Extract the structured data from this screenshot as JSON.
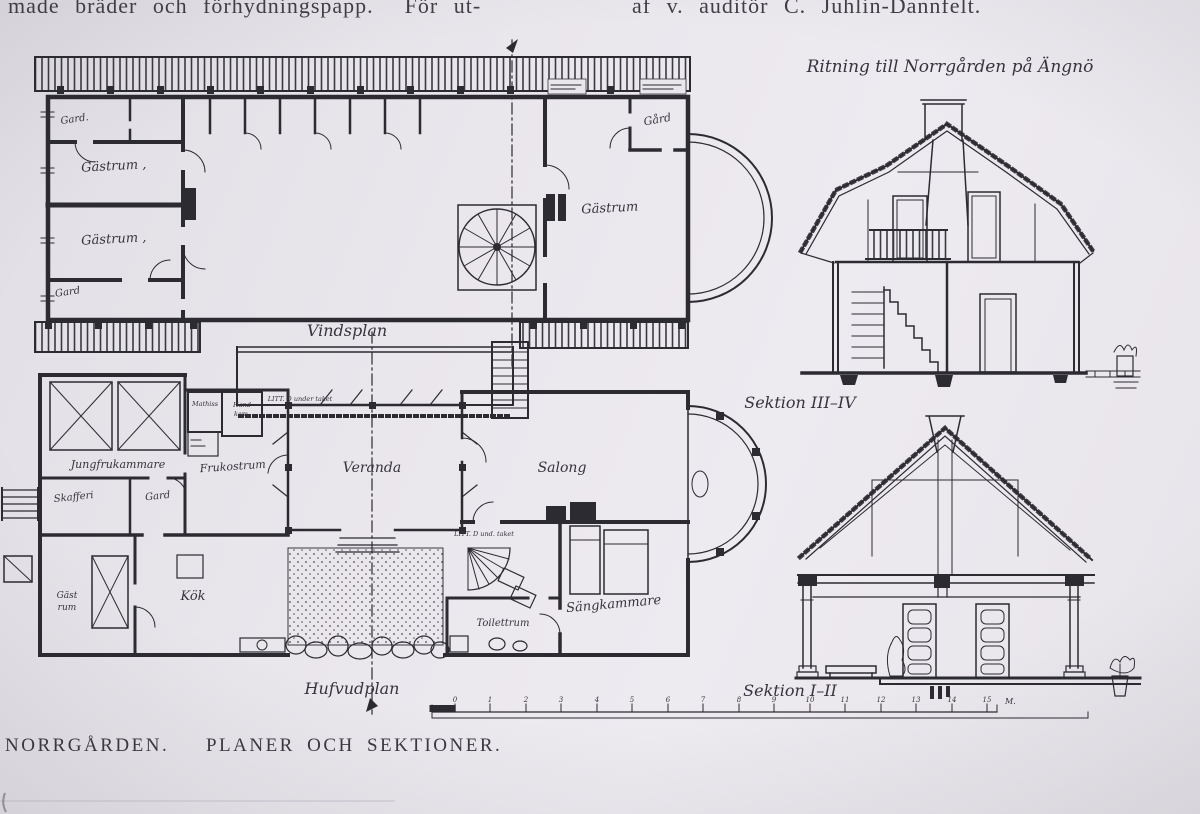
{
  "page": {
    "top_text_left": "made bräder och förhydningspapp.  För ut-",
    "top_text_right": "af v. auditör C. Juhlin-Dannfelt.",
    "caption": "NORRGÅRDEN.   PLANER OCH SEKTIONER.",
    "paper_color": "#e9e6ec",
    "ink_color": "#2c2b32"
  },
  "drawing": {
    "title": "Ritning till Norrgården på Ängnö",
    "attic_plan": {
      "label": "Vindsplan",
      "rooms": {
        "gard_top_left": "Gard.",
        "gastrum_1": "Gästrum ,",
        "gastrum_2": "Gästrum ,",
        "gard_bottom_left": "Gard",
        "gard_top_right": "Gård",
        "gastrum_3": "Gästrum"
      }
    },
    "main_plan": {
      "label": "Hufvudplan",
      "rooms": {
        "jungfrukammare": "Jungfrukammare",
        "skafferi": "Skafferi",
        "gard": "Gard",
        "mathiss": "Mathiss",
        "handkammare_line1": "Hand",
        "handkammare_line2": "kam.",
        "litt_d_note_1": "LITT. D under taket",
        "frukostrum": "Frukostrum",
        "veranda": "Veranda",
        "salong": "Salong",
        "gastrum_line1": "Gäst",
        "gastrum_line2": "rum",
        "kok": "Kök",
        "litt_d_note_2": "LITT. D und. taket",
        "toilettrum": "Toilettrum",
        "sangkammare": "Sängkammare"
      }
    },
    "sections": {
      "upper_label": "Sektion III–IV",
      "lower_label": "Sektion I–II"
    },
    "scale_bar": {
      "tick_labels": [
        "0",
        "1",
        "2",
        "3",
        "4",
        "5",
        "6",
        "7",
        "8",
        "9",
        "10",
        "11",
        "12",
        "13",
        "14",
        "15"
      ],
      "unit": "M."
    }
  }
}
